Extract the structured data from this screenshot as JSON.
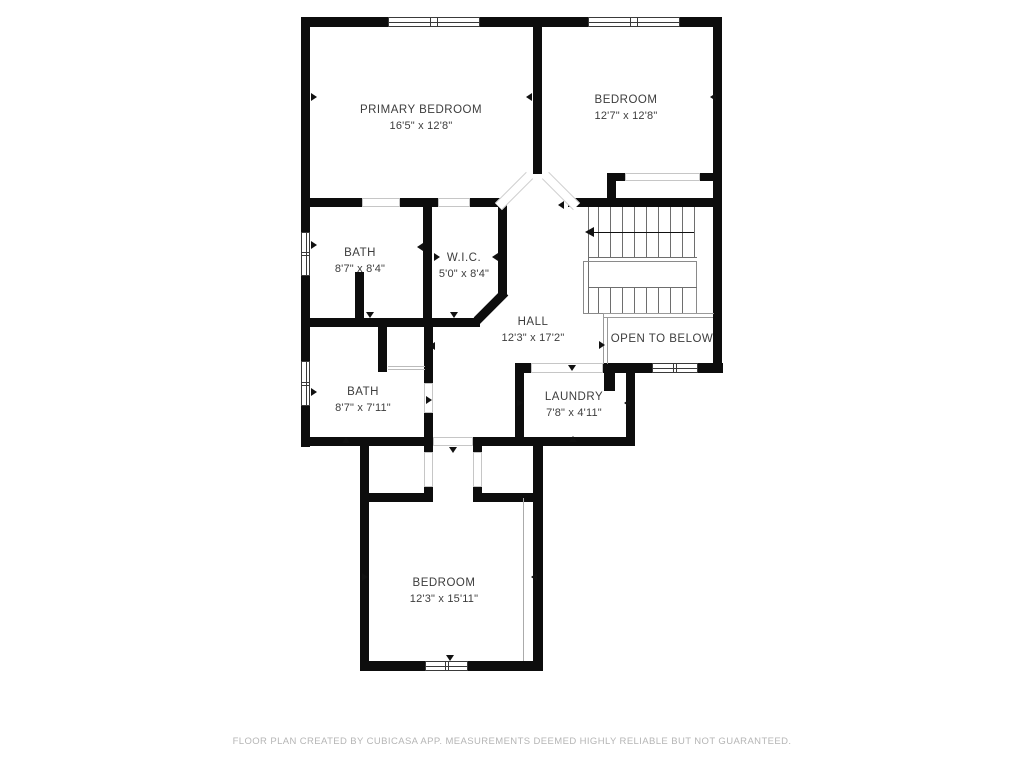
{
  "footer": {
    "text": "FLOOR PLAN CREATED BY CUBICASA APP. MEASUREMENTS DEEMED HIGHLY RELIABLE BUT NOT GUARANTEED."
  },
  "rooms": [
    {
      "id": "primary-bedroom",
      "name": "PRIMARY BEDROOM",
      "dims": "16'5\" x 12'8\"",
      "x": 421,
      "y": 118
    },
    {
      "id": "bedroom-top",
      "name": "BEDROOM",
      "dims": "12'7\" x 12'8\"",
      "x": 626,
      "y": 108
    },
    {
      "id": "bath-upper",
      "name": "BATH",
      "dims": "8'7\" x 8'4\"",
      "x": 360,
      "y": 261
    },
    {
      "id": "wic",
      "name": "W.I.C.",
      "dims": "5'0\" x 8'4\"",
      "x": 464,
      "y": 266
    },
    {
      "id": "hall",
      "name": "HALL",
      "dims": "12'3\" x 17'2\"",
      "x": 533,
      "y": 330
    },
    {
      "id": "bath-lower",
      "name": "BATH",
      "dims": "8'7\" x 7'11\"",
      "x": 363,
      "y": 400
    },
    {
      "id": "laundry",
      "name": "LAUNDRY",
      "dims": "7'8\" x 4'11\"",
      "x": 574,
      "y": 405
    },
    {
      "id": "bedroom-bottom",
      "name": "BEDROOM",
      "dims": "12'3\" x 15'11\"",
      "x": 444,
      "y": 591
    },
    {
      "id": "open-to-below",
      "name": "OPEN TO BELOW",
      "dims": "",
      "x": 662,
      "y": 339
    }
  ],
  "colors": {
    "wall": "#0d0d0d",
    "text": "#3d3d3d",
    "thin": "#6e6e6e",
    "footer_text": "#b5b5b5"
  },
  "floorplan": {
    "walls": [
      [
        301,
        17,
        421,
        10
      ],
      [
        301,
        17,
        9,
        430
      ],
      [
        713,
        17,
        9,
        356
      ],
      [
        533,
        27,
        9,
        147
      ],
      [
        301,
        198,
        206,
        9
      ],
      [
        498,
        198,
        9,
        99
      ],
      [
        423,
        198,
        9,
        129
      ],
      [
        301,
        318,
        179,
        9
      ],
      [
        355,
        272,
        9,
        46
      ],
      [
        378,
        327,
        9,
        45
      ],
      [
        424,
        327,
        9,
        110
      ],
      [
        301,
        437,
        132,
        9
      ],
      [
        473,
        437,
        162,
        9
      ],
      [
        360,
        437,
        9,
        234
      ],
      [
        360,
        493,
        70,
        9
      ],
      [
        473,
        493,
        70,
        9
      ],
      [
        424,
        437,
        9,
        65
      ],
      [
        473,
        437,
        9,
        65
      ],
      [
        533,
        437,
        10,
        234
      ],
      [
        360,
        661,
        183,
        10
      ],
      [
        515,
        363,
        9,
        83
      ],
      [
        626,
        363,
        9,
        83
      ],
      [
        515,
        363,
        208,
        10
      ],
      [
        604,
        373,
        11,
        18
      ],
      [
        568,
        198,
        145,
        9
      ],
      [
        607,
        173,
        106,
        8
      ],
      [
        607,
        173,
        9,
        34
      ]
    ],
    "windows": [
      [
        388,
        17,
        92,
        10
      ],
      [
        588,
        17,
        92,
        10
      ],
      [
        301,
        232,
        9,
        44
      ],
      [
        301,
        361,
        9,
        45
      ],
      [
        652,
        363,
        46,
        10
      ],
      [
        425,
        661,
        43,
        10
      ]
    ],
    "openings": [
      [
        362,
        198,
        38,
        9
      ],
      [
        438,
        198,
        32,
        9
      ],
      [
        625,
        173,
        75,
        8
      ],
      [
        424,
        383,
        9,
        30
      ],
      [
        531,
        363,
        72,
        10
      ],
      [
        424,
        452,
        9,
        35
      ],
      [
        473,
        452,
        9,
        35
      ],
      [
        433,
        437,
        40,
        9
      ]
    ],
    "diag_walls": [
      {
        "cx": 491,
        "cy": 306,
        "len": 40,
        "rot": -45,
        "th": 9
      }
    ],
    "diag_openings": [
      {
        "cx": 514,
        "cy": 191,
        "len": 44,
        "rot": -45,
        "th": 10
      },
      {
        "cx": 561,
        "cy": 191,
        "len": 44,
        "rot": 45,
        "th": 10
      }
    ],
    "thin_lines": [
      [
        588,
        207,
        1,
        106,
        "#6e6e6e"
      ],
      [
        598,
        207,
        1,
        50,
        "#6e6e6e"
      ],
      [
        610,
        207,
        1,
        50,
        "#6e6e6e"
      ],
      [
        622,
        207,
        1,
        50,
        "#6e6e6e"
      ],
      [
        634,
        207,
        1,
        50,
        "#6e6e6e"
      ],
      [
        646,
        207,
        1,
        50,
        "#6e6e6e"
      ],
      [
        658,
        207,
        1,
        50,
        "#6e6e6e"
      ],
      [
        670,
        207,
        1,
        50,
        "#6e6e6e"
      ],
      [
        682,
        207,
        1,
        50,
        "#6e6e6e"
      ],
      [
        694,
        207,
        1,
        50,
        "#6e6e6e"
      ],
      [
        588,
        257,
        109,
        1,
        "#6e6e6e"
      ],
      [
        583,
        261,
        114,
        1,
        "#8a8a8a"
      ],
      [
        583,
        313,
        114,
        1,
        "#8a8a8a"
      ],
      [
        583,
        261,
        1,
        52,
        "#8a8a8a"
      ],
      [
        696,
        261,
        1,
        52,
        "#8a8a8a"
      ],
      [
        598,
        287,
        1,
        26,
        "#6e6e6e"
      ],
      [
        610,
        287,
        1,
        26,
        "#6e6e6e"
      ],
      [
        622,
        287,
        1,
        26,
        "#6e6e6e"
      ],
      [
        634,
        287,
        1,
        26,
        "#6e6e6e"
      ],
      [
        646,
        287,
        1,
        26,
        "#6e6e6e"
      ],
      [
        658,
        287,
        1,
        26,
        "#6e6e6e"
      ],
      [
        670,
        287,
        1,
        26,
        "#6e6e6e"
      ],
      [
        682,
        287,
        1,
        26,
        "#6e6e6e"
      ],
      [
        588,
        287,
        109,
        1,
        "#6e6e6e"
      ],
      [
        594,
        232,
        100,
        1,
        "#111111"
      ],
      [
        603,
        313,
        111,
        1,
        "#9a9a9a"
      ],
      [
        603,
        317,
        110,
        1,
        "#9a9a9a"
      ],
      [
        603,
        313,
        1,
        51,
        "#9a9a9a"
      ],
      [
        607,
        317,
        1,
        47,
        "#9a9a9a"
      ],
      [
        523,
        498,
        1,
        163,
        "#ababab"
      ],
      [
        388,
        366,
        37,
        1,
        "#bbbbbb"
      ],
      [
        388,
        369,
        37,
        1,
        "#bbbbbb"
      ]
    ],
    "markers": [
      {
        "x": 311,
        "y": 93,
        "d": "right"
      },
      {
        "x": 526,
        "y": 93,
        "d": "left"
      },
      {
        "x": 710,
        "y": 93,
        "d": "left"
      },
      {
        "x": 311,
        "y": 241,
        "d": "right"
      },
      {
        "x": 417,
        "y": 243,
        "d": "left"
      },
      {
        "x": 434,
        "y": 253,
        "d": "right"
      },
      {
        "x": 492,
        "y": 253,
        "d": "left"
      },
      {
        "x": 366,
        "y": 312,
        "d": "down"
      },
      {
        "x": 450,
        "y": 312,
        "d": "down"
      },
      {
        "x": 311,
        "y": 388,
        "d": "right"
      },
      {
        "x": 429,
        "y": 342,
        "d": "left"
      },
      {
        "x": 426,
        "y": 396,
        "d": "right"
      },
      {
        "x": 342,
        "y": 437,
        "d": "up"
      },
      {
        "x": 449,
        "y": 447,
        "d": "down"
      },
      {
        "x": 517,
        "y": 399,
        "d": "right"
      },
      {
        "x": 624,
        "y": 399,
        "d": "left"
      },
      {
        "x": 569,
        "y": 436,
        "d": "up"
      },
      {
        "x": 568,
        "y": 365,
        "d": "down"
      },
      {
        "x": 362,
        "y": 573,
        "d": "right"
      },
      {
        "x": 531,
        "y": 573,
        "d": "left"
      },
      {
        "x": 446,
        "y": 655,
        "d": "down"
      },
      {
        "x": 599,
        "y": 341,
        "d": "right"
      },
      {
        "x": 558,
        "y": 201,
        "d": "left"
      }
    ],
    "stair_arrow_head": {
      "x": 585,
      "y": 227
    }
  }
}
